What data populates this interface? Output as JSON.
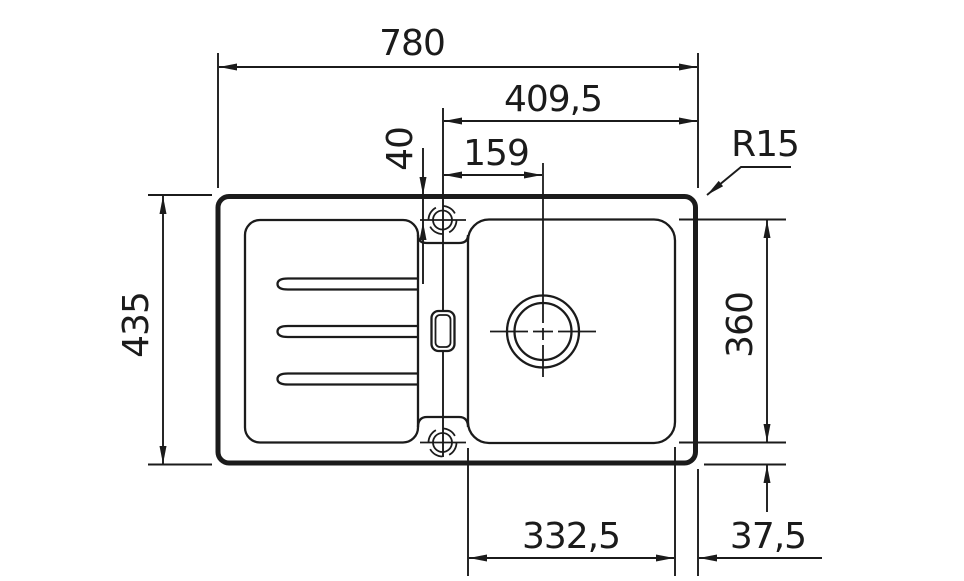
{
  "drawing": {
    "kind": "sink-installation-dimension-drawing",
    "dims": {
      "overall_width": "780",
      "tap_to_right_edge": "409,5",
      "tap_to_drain": "159",
      "tap_edge_offset": "40",
      "corner_radius": "R15",
      "overall_depth": "435",
      "bowl_depth": "360",
      "bowl_width": "332,5",
      "side_margin": "37,5"
    }
  }
}
